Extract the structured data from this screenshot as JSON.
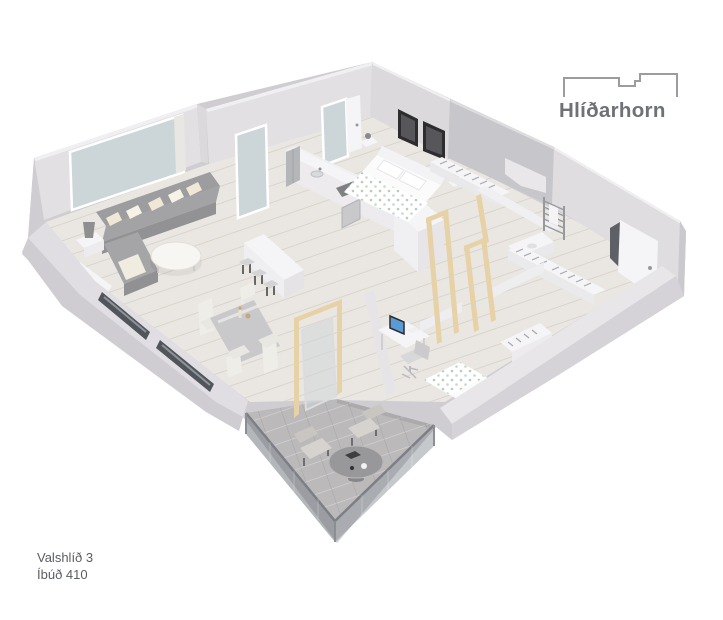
{
  "page": {
    "background": "#ffffff"
  },
  "logo": {
    "text": "Hlíðarhorn",
    "text_color": "#6e7176",
    "icon": "buildings-skyline-outline-icon",
    "icon_color": "#9b9ba0"
  },
  "address": {
    "line1": "Valshlíð 3",
    "line2": "Íbúð 410",
    "color": "#5a5d62"
  },
  "floorplan": {
    "type": "3d-apartment-floor-plan-render",
    "rooms": [
      "living-room",
      "dining-area",
      "kitchen",
      "master-bedroom",
      "bedroom",
      "hallway",
      "bathroom",
      "balcony"
    ],
    "colors": {
      "wall": "#e2e0e3",
      "wall_shadow": "#cbc9cd",
      "wall_top": "#f0eff1",
      "floor": "#eae7e2",
      "window_glass": "#ccd6d9",
      "paver": "#bcb9bb",
      "balcony_glass_left": "rgba(104,110,118,0.50)",
      "balcony_glass_right": "rgba(120,126,134,0.42)",
      "wood_frame": "#e7d2a8",
      "sofa": "#a3a2a4",
      "duvet_accent": "#b7cdbc",
      "art": "#2d2d30",
      "steel": "#b4b6b9",
      "monitor_screen": "#5a9bd5"
    }
  }
}
